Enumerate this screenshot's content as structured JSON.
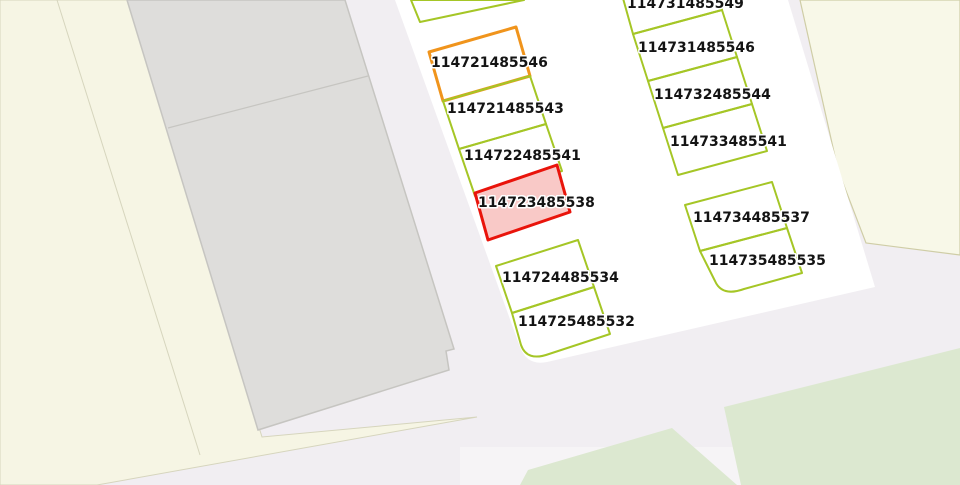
{
  "map": {
    "description": "cadastral-parcel-map-view",
    "width": 960,
    "height": 485,
    "colors": {
      "base": "#f1eef2",
      "cream_left": "#f6f5e4",
      "cream_topright": "#f8f8e8",
      "cream_border": "#d6d5bd",
      "cream_border_olive": "#cfcda6",
      "building_fill": "#dedddb",
      "building_stroke": "#c6c5c1",
      "parcel_block_fill": "#ffffff",
      "vegetation": "#dce8d0",
      "road_light": "#f6f4f6",
      "parcel_green": "#a5c626",
      "parcel_orange": "#f0941c",
      "parcel_red": "#e9140b",
      "selected_fill": "#f9c9c7",
      "label": "#141414",
      "halo": "#ffffff"
    },
    "areas": [
      {
        "name": "map-background",
        "points": "0,0 960,0 960,485 0,485",
        "fill": "base"
      },
      {
        "name": "landuse-cream-left",
        "points": "0,0 127,0 262,437 477,417 97,485 0,485",
        "fill": "cream_left",
        "stroke": "cream_border",
        "stroke_width": 1
      },
      {
        "name": "landuse-cream-topright",
        "points": "800,0 960,0 960,255 866,243 838,170",
        "fill": "cream_topright",
        "stroke": "cream_border_olive",
        "stroke_width": 1.2
      },
      {
        "name": "road-light-strip",
        "points": "460,447 960,447 960,485 460,485",
        "fill": "road_light"
      },
      {
        "name": "vegetation-bottom-right",
        "points": "724,407 960,348 960,485 741,485",
        "fill": "vegetation"
      },
      {
        "name": "vegetation-bottom-center",
        "points": "672,428 737,485 520,485 528,470",
        "fill": "vegetation"
      },
      {
        "name": "parcel-block",
        "path": "M 395,0 L 520,347 Q 527,366 547,362 L 875,287 L 788,0 Z",
        "fill": "parcel_block_fill"
      },
      {
        "name": "building",
        "path": "M 127,0 L 345,0 L 454,349 L 446,351 L 449,370 L 258,430 Z",
        "fill": "building_fill",
        "stroke": "building_stroke",
        "stroke_width": 1.5
      }
    ],
    "lines": [
      {
        "name": "cream-parcel-divider",
        "x1": 57,
        "y1": 0,
        "x2": 200,
        "y2": 455,
        "stroke": "cream_border",
        "stroke_width": 1
      },
      {
        "name": "building-divider",
        "x1": 168,
        "y1": 128,
        "x2": 368,
        "y2": 76,
        "stroke": "building_stroke",
        "stroke_width": 1.2
      }
    ],
    "parcels": [
      {
        "id": "",
        "name": "parcel-partial-top-left",
        "points": "411,0 420,22 524,0",
        "outline": "green"
      },
      {
        "id": "114721485546",
        "points": "429,52 516,27 530,76 443,101",
        "outline": "orange",
        "label_x": 431,
        "label_y": 67
      },
      {
        "id": "114721485543",
        "points": "443,101 530,76 546,124 459,149",
        "outline": "green",
        "label_x": 447,
        "label_y": 113
      },
      {
        "id": "114722485541",
        "points": "459,149 546,124 562,171 475,196",
        "outline": "green",
        "label_x": 464,
        "label_y": 160
      },
      {
        "id": "114723485538",
        "points": "475,193 557,165 570,212 488,240",
        "outline": "red",
        "fill": "selected_fill",
        "selected": true,
        "label_x": 478,
        "label_y": 207
      },
      {
        "id": "114724485534",
        "points": "496,266 578,240 594,287 512,313",
        "outline": "green",
        "label_x": 502,
        "label_y": 282
      },
      {
        "id": "114725485532",
        "path": "M 512,313 L 594,287 L 610,334 L 549,354 Q 527,362 521,345 Z",
        "outline": "green",
        "label_x": 518,
        "label_y": 326
      },
      {
        "id": "114731485549",
        "points": "619,-16 708,-40 722,10 633,34",
        "outline": "green",
        "label_x": 627,
        "label_y": 8
      },
      {
        "id": "114731485546",
        "points": "633,34 722,10 737,57 648,81",
        "outline": "green",
        "label_x": 638,
        "label_y": 52
      },
      {
        "id": "114732485544",
        "points": "648,81 737,57 752,104 663,128",
        "outline": "green",
        "label_x": 654,
        "label_y": 99
      },
      {
        "id": "114733485541",
        "points": "663,128 752,104 767,151 678,175",
        "outline": "green",
        "label_x": 670,
        "label_y": 146
      },
      {
        "id": "114734485537",
        "points": "685,205 772,182 787,228 700,251",
        "outline": "green",
        "label_x": 693,
        "label_y": 222
      },
      {
        "id": "114735485535",
        "path": "M 700,251 L 787,228 L 802,273 L 744,289 Q 722,297 715,281 Z",
        "outline": "green",
        "label_x": 709,
        "label_y": 265
      }
    ]
  }
}
